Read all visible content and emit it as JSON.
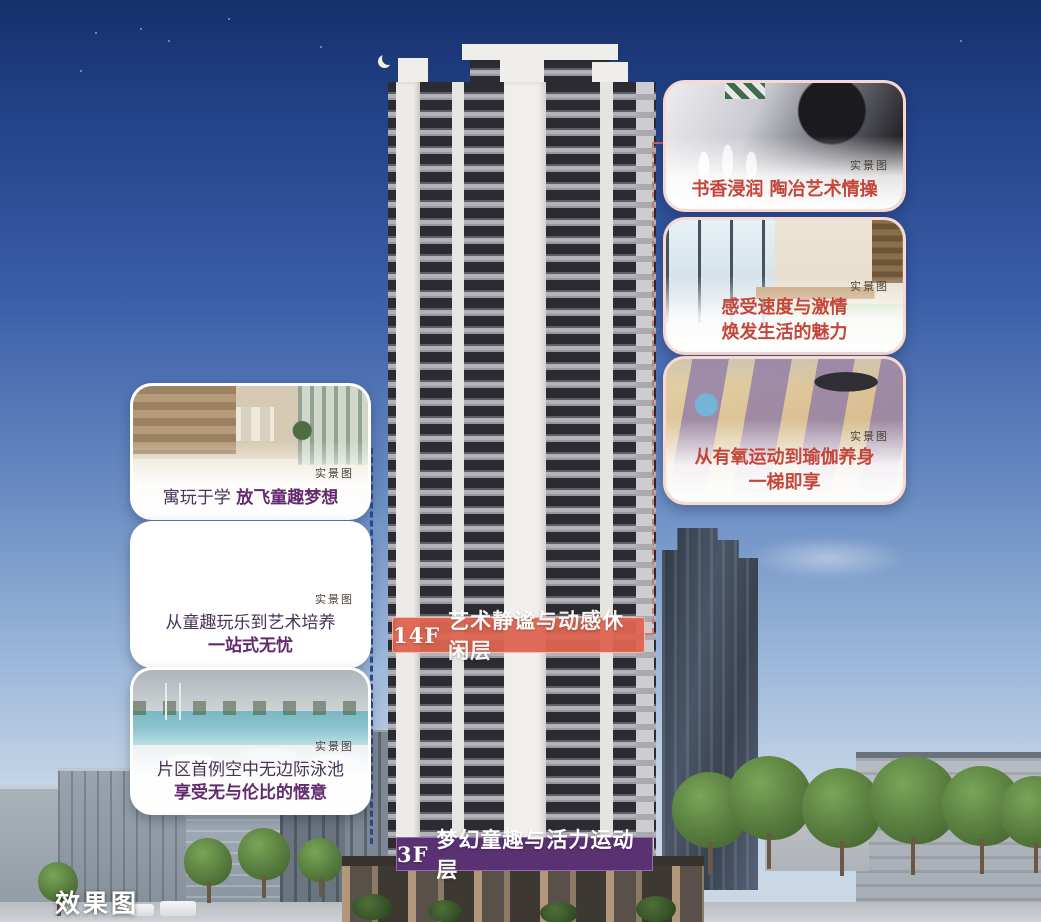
{
  "watermark": "效果图",
  "colors": {
    "banner_mid": "#de6450",
    "banner_bottom": "#5a3173",
    "caption_left": "#473457",
    "caption_left_bold": "#632a6e",
    "caption_right": "#c4453a",
    "connector_left": "#2a4a94",
    "connector_right": "#d66e5c",
    "sky_top": "#16306b",
    "sky_bottom": "#ccd9e6"
  },
  "banners": {
    "mid": {
      "floor": "14F",
      "title": "艺术静谧与动感休闲层"
    },
    "bottom": {
      "floor": "3F",
      "title": "梦幻童趣与活力运动层"
    }
  },
  "left_cards": [
    {
      "tag": "实景图",
      "t1": "寓玩于学 ",
      "t2": "放飞童趣梦想"
    },
    {
      "tag": "实景图",
      "t1": "从童趣玩乐到艺术培养",
      "t2": "一站式无忧"
    },
    {
      "tag": "实景图",
      "t1": "片区首例空中无边际泳池",
      "t2": "享受无与伦比的惬意"
    }
  ],
  "right_cards": [
    {
      "tag": "实景图",
      "t1": "书香浸润 ",
      "t2": "陶冶艺术情操"
    },
    {
      "tag": "实景图",
      "t1": "感受速度与激情",
      "t2": "焕发生活的魅力"
    },
    {
      "tag": "实景图",
      "t1": "从有氧运动到瑜伽养身",
      "t2": "一梯即享"
    }
  ]
}
